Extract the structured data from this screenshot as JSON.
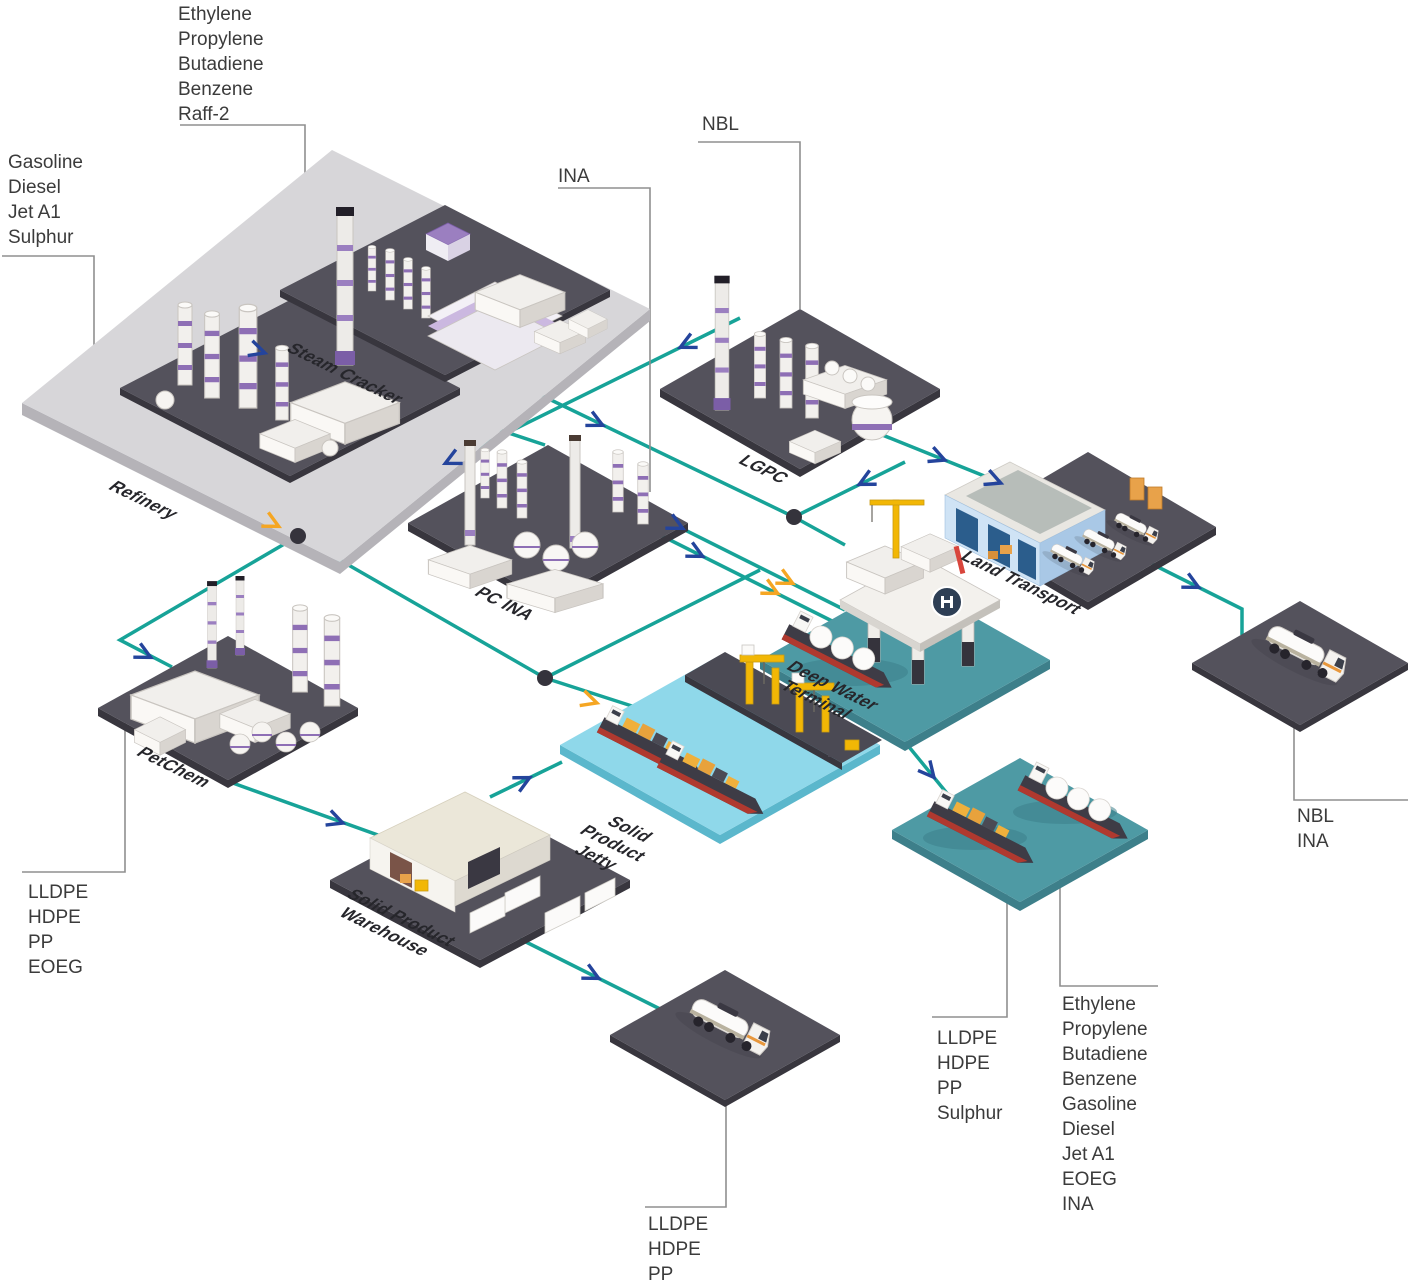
{
  "diagram": {
    "type": "isometric-flow-diagram",
    "facilities": {
      "refinery": {
        "label": "Refinery"
      },
      "steam_cracker": {
        "label": "Steam Cracker"
      },
      "lgpc": {
        "label": "LGPC"
      },
      "pc_ina": {
        "label": "PC INA"
      },
      "land_transport": {
        "label": "Land Transport"
      },
      "petchem": {
        "label": "PetChem"
      },
      "deep_water_terminal": {
        "label": "Deep Water\nTerminal"
      },
      "solid_product_jetty": {
        "label": "Solid\nProduct\nJetty"
      },
      "solid_product_warehouse": {
        "label": "Solid Product\nWarehouse"
      }
    },
    "product_labels": {
      "steam_cracker_products": {
        "text": "Ethylene\nPropylene\nButadiene\nBenzene\nRaff-2"
      },
      "refinery_products": {
        "text": "Gasoline\nDiesel\nJet A1\nSulphur"
      },
      "pc_ina_feed": {
        "text": "INA"
      },
      "lgpc_feed": {
        "text": "NBL"
      },
      "right_truck_products": {
        "text": "NBL\nINA"
      },
      "petchem_products": {
        "text": "LLDPE\nHDPE\nPP\nEOEG"
      },
      "solid_ship_products": {
        "text": "LLDPE\nHDPE\nPP\nSulphur"
      },
      "liquid_ship_products": {
        "text": "Ethylene\nPropylene\nButadiene\nBenzene\nGasoline\nDiesel\nJet A1\nEOEG\nINA"
      },
      "bottom_truck_products": {
        "text": "LLDPE\nHDPE\nPP"
      }
    },
    "colors": {
      "flow_line": "#17a398",
      "arrow_blue": "#24449c",
      "arrow_yellow": "#f5a623",
      "connector_gray": "#8f8f8f",
      "platform_dark": "#54525c",
      "platform_light": "#d7d6d9",
      "sea_teal": "#4e9aa4",
      "water_light": "#8fd8ea",
      "purple_accent": "#8e6fb5",
      "crane_yellow": "#f2b705",
      "hull_red": "#b0392f"
    }
  }
}
